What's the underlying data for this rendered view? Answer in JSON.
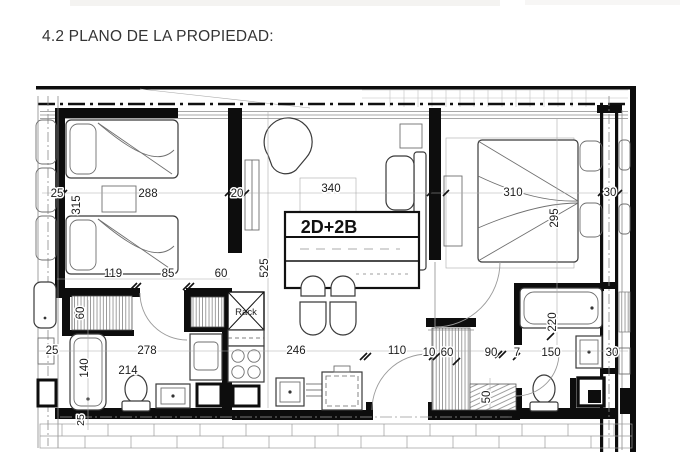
{
  "page": {
    "title": "4.2 PLANO DE LA PROPIEDAD:"
  },
  "plan": {
    "unit_type": "2D+2B",
    "rack_label": "Rack",
    "dims": {
      "b1_wall_left": "25",
      "b1_depth": "315",
      "b1_width": "288",
      "b1_wall_right": "20",
      "b1_closet_left": "119",
      "b1_door": "85",
      "b1_closet_right": "60",
      "closet_left_depth": "60",
      "living_width": "340",
      "living_depth": "525",
      "b2_width": "310",
      "b2_depth": "295",
      "b2_wall_right": "30",
      "bath1_width": "278",
      "bath1_toilet": "214",
      "bath1_tub": "140",
      "bath1_bottom_wall": "25",
      "neighbor_left": "25",
      "kitchen_width": "246",
      "entry_door": "110",
      "entry_a": "10",
      "entry_b": "60",
      "entry_c": "90",
      "entry_d": "7",
      "bath2_sink": "150",
      "bath2_wall": "30",
      "bath2_tub": "220",
      "entry_closet": "50"
    }
  }
}
